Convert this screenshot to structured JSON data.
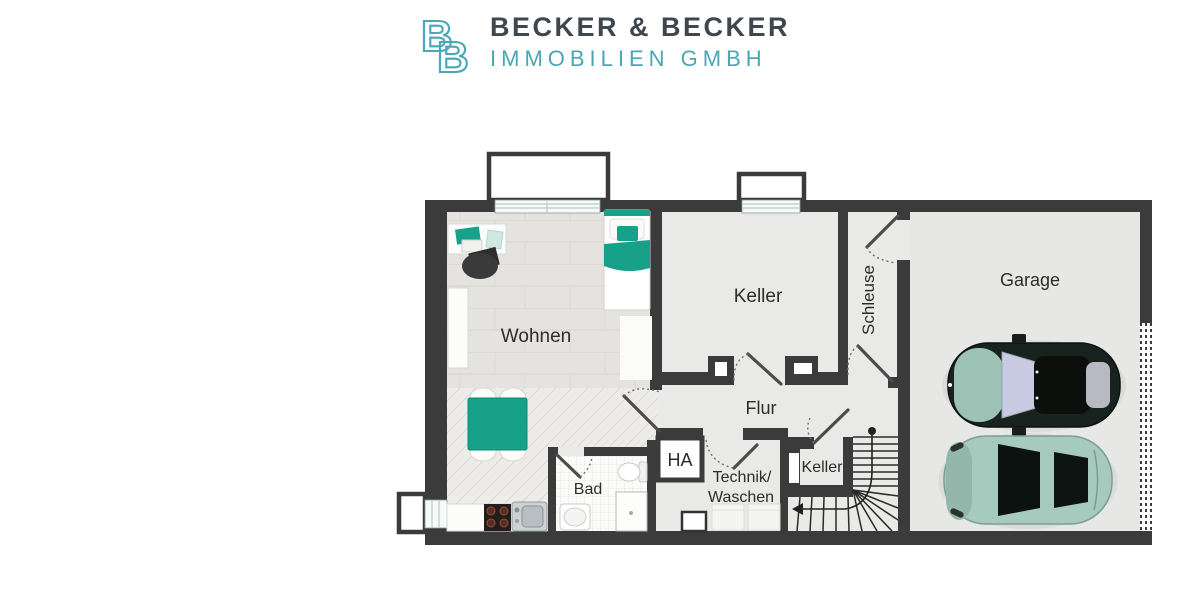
{
  "header": {
    "logo_letter": "B",
    "company_name": "BECKER & BECKER",
    "company_subtitle": "IMMOBILIEN GMBH"
  },
  "labels": {
    "wohnen": "Wohnen",
    "keller_main": "Keller",
    "schleuse": "Schleuse",
    "garage": "Garage",
    "flur": "Flur",
    "bad": "Bad",
    "ha": "HA",
    "technik_line1": "Technik/",
    "technik_line2": "Waschen",
    "keller_small": "Keller"
  },
  "colors": {
    "wall": "#3b3b3b",
    "accent-teal": "#17a189",
    "logo-teal": "#4aa7b4",
    "logo-dark": "#3e464e",
    "floor": "#e9e9e8",
    "label-ink": "#2c2c2c"
  }
}
